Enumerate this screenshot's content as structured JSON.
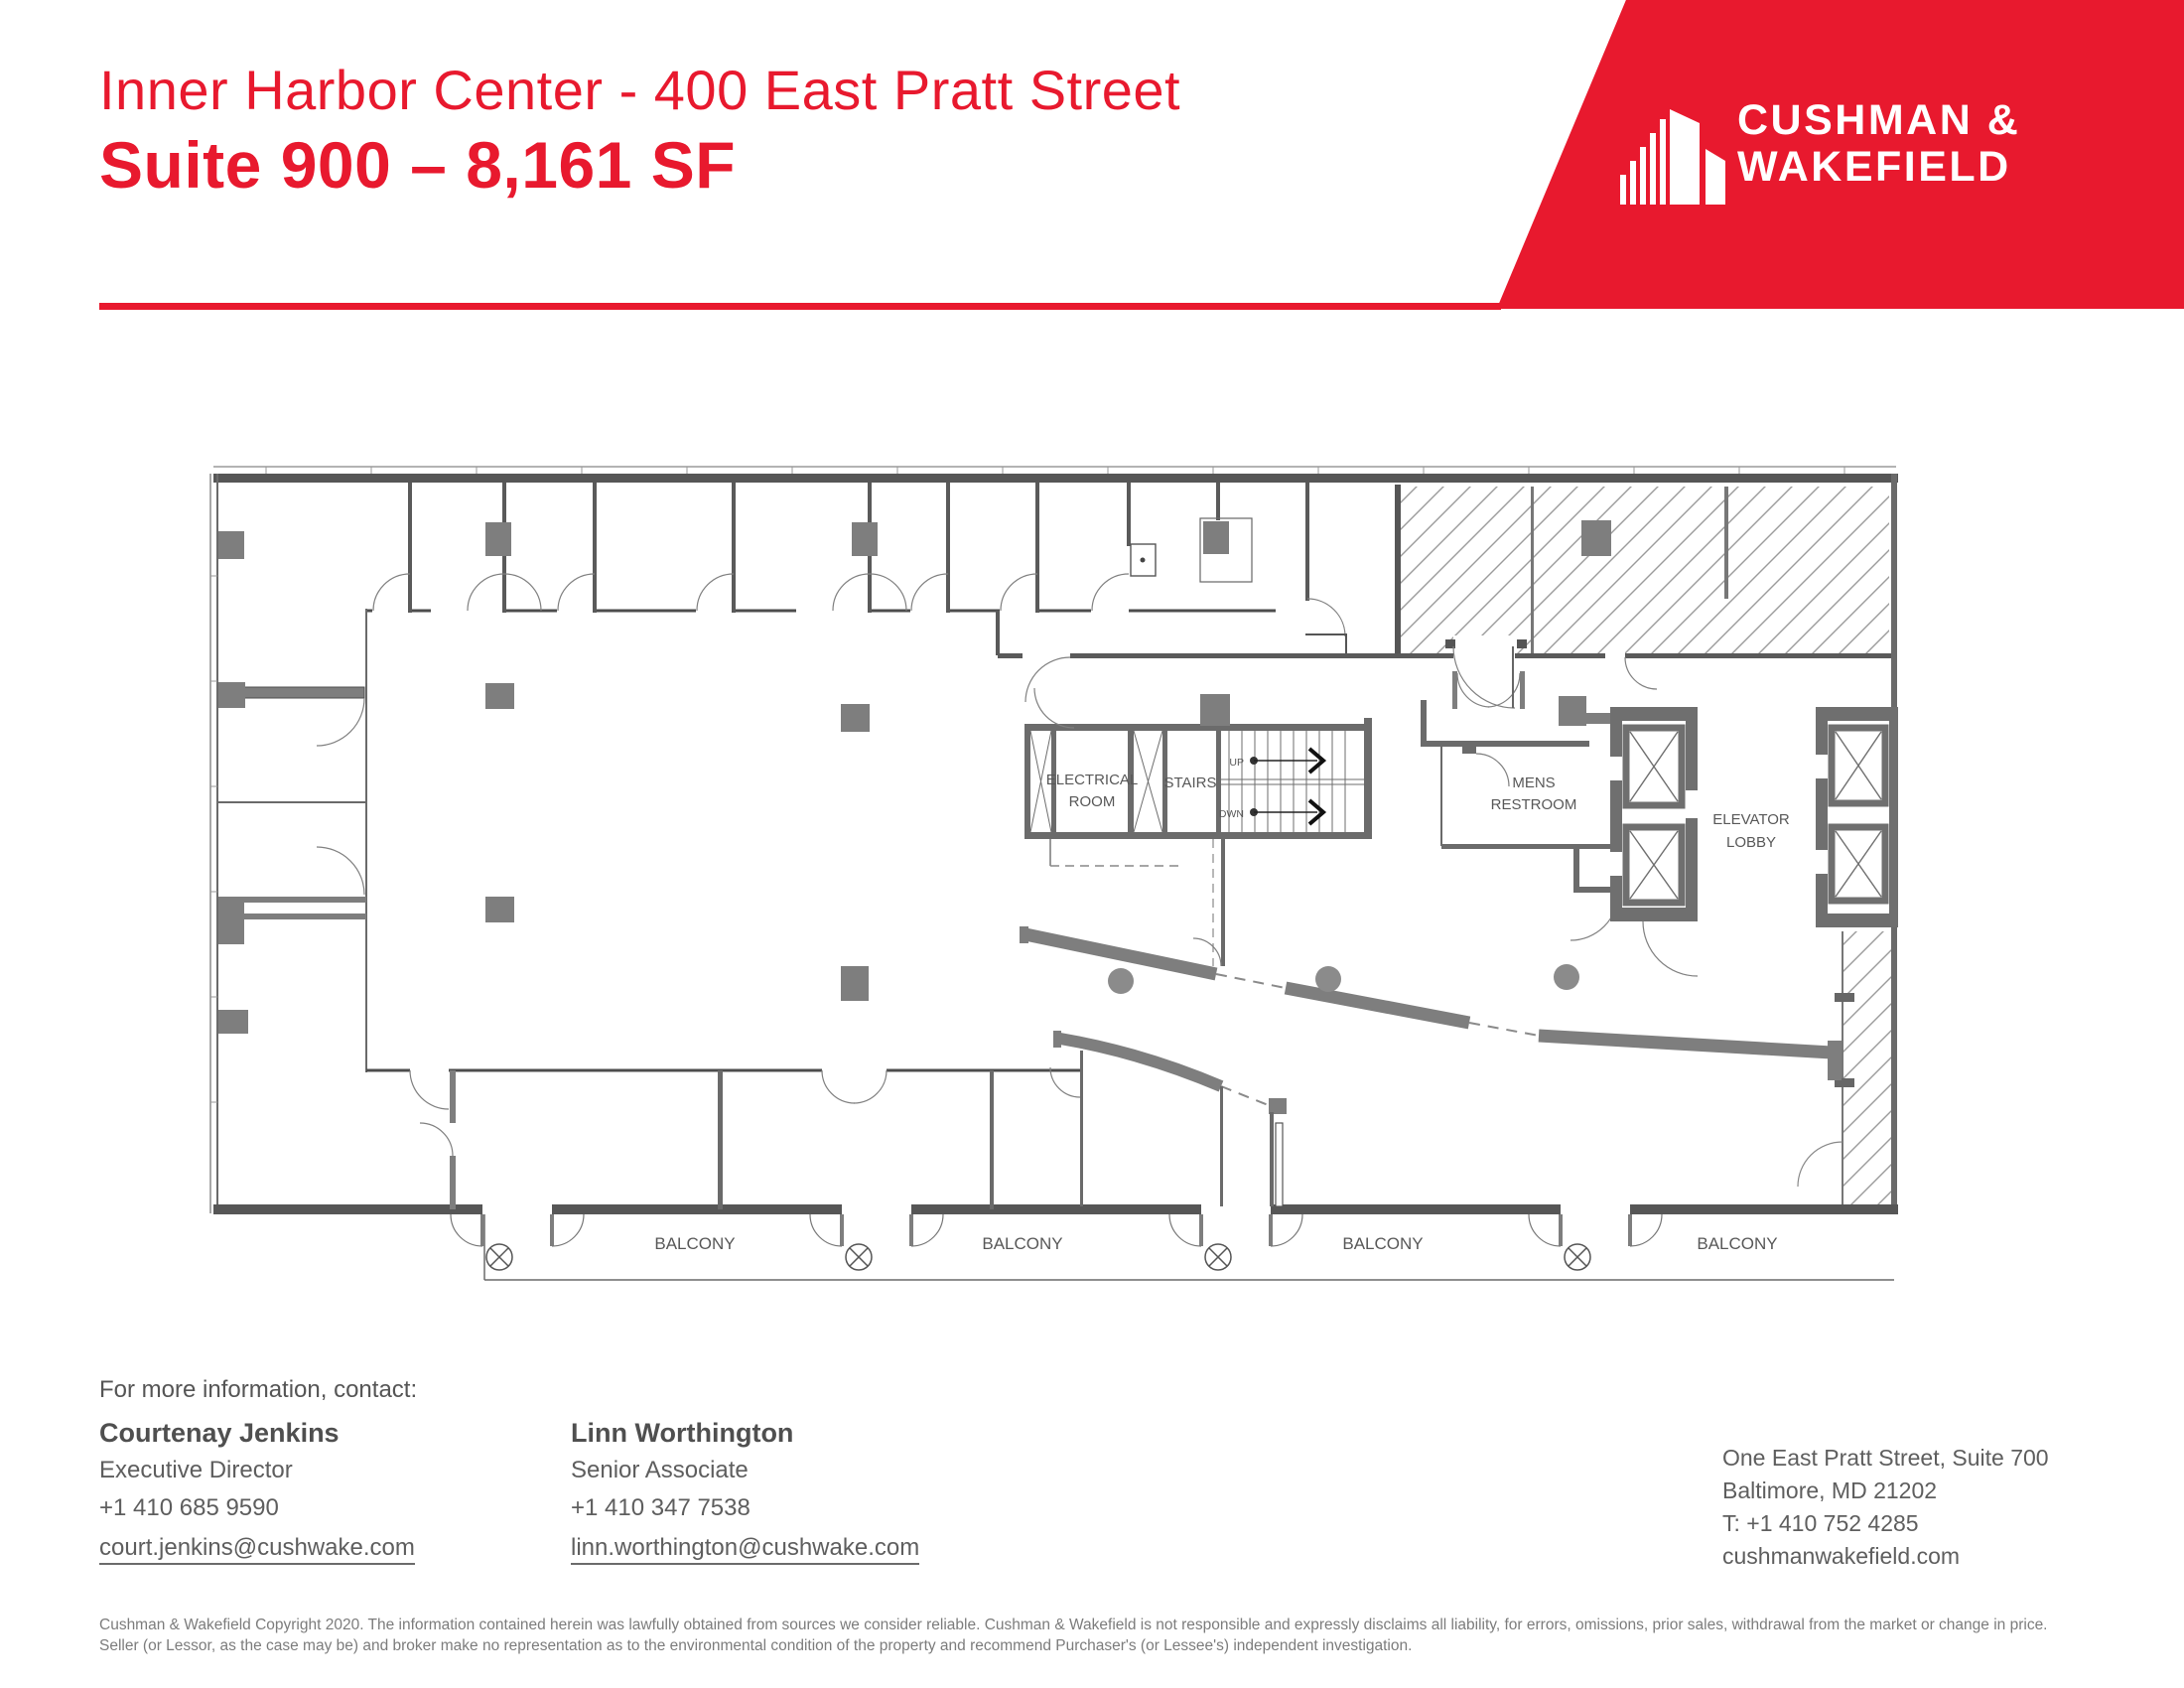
{
  "header": {
    "building_line": "Inner Harbor Center - 400 East Pratt Street",
    "suite_line": "Suite 900 – 8,161 SF"
  },
  "brand": {
    "name_line1": "CUSHMAN &",
    "name_line2": "WAKEFIELD",
    "red": "#E8192E"
  },
  "plan": {
    "labels": {
      "electrical1": "ELECTRICAL",
      "electrical2": "ROOM",
      "stairs": "STAIRS",
      "up": "UP",
      "down": "DWN",
      "mens1": "MENS",
      "mens2": "RESTROOM",
      "elevator1": "ELEVATOR",
      "elevator2": "LOBBY"
    },
    "balcony_labels": [
      "BALCONY",
      "BALCONY",
      "BALCONY",
      "BALCONY"
    ]
  },
  "contact": {
    "heading": "For more information, contact:",
    "people": [
      {
        "name": "Courtenay Jenkins",
        "title": "Executive Director",
        "phone": "+1 410 685 9590",
        "email": "court.jenkins@cushwake.com"
      },
      {
        "name": "Linn Worthington",
        "title": "Senior Associate",
        "phone": "+1 410 347 7538",
        "email": "linn.worthington@cushwake.com"
      }
    ]
  },
  "office": {
    "address_line1": "One East Pratt Street, Suite 700",
    "address_line2": "Baltimore, MD 21202",
    "phone": "T: +1 410 752 4285",
    "website": "cushmanwakefield.com"
  },
  "disclaimer": "Cushman & Wakefield Copyright 2020. The information contained herein was lawfully obtained from sources we consider reliable. Cushman & Wakefield is not responsible and expressly disclaims all liability, for errors, omissions, prior sales,  withdrawal from the market or change in price. Seller (or Lessor, as the case may be) and broker make no representation as to the environmental condition of the property and recommend Purchaser's (or Lessee's) independent investigation."
}
